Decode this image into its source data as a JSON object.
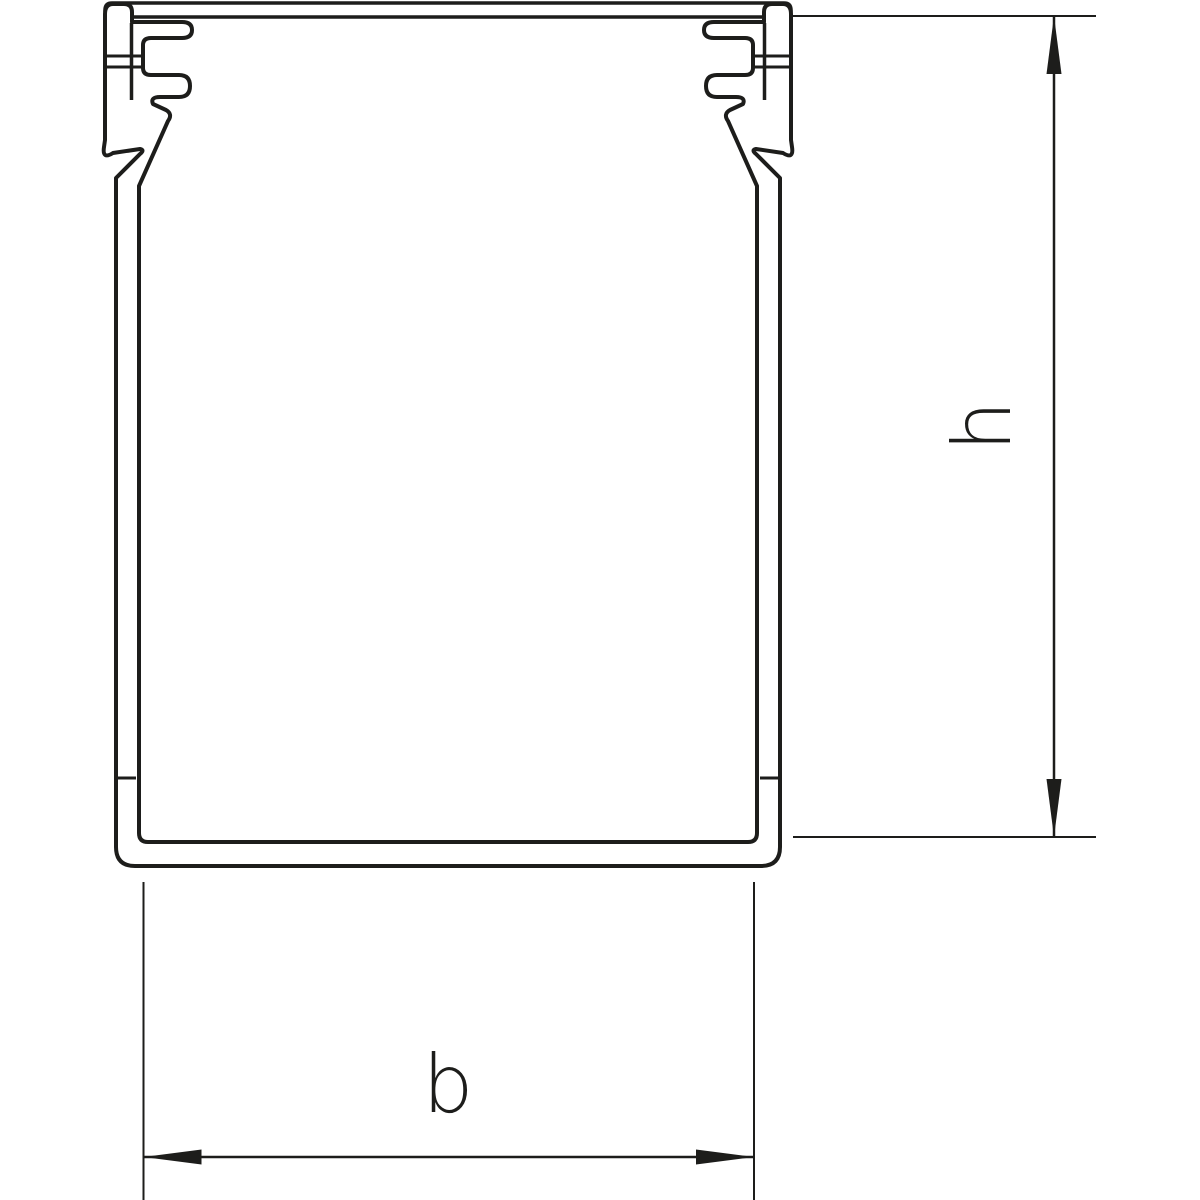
{
  "drawing": {
    "labels": {
      "height": "h",
      "width": "b"
    },
    "colors": {
      "line": "#1d1d1b",
      "background": "#ffffff"
    }
  }
}
